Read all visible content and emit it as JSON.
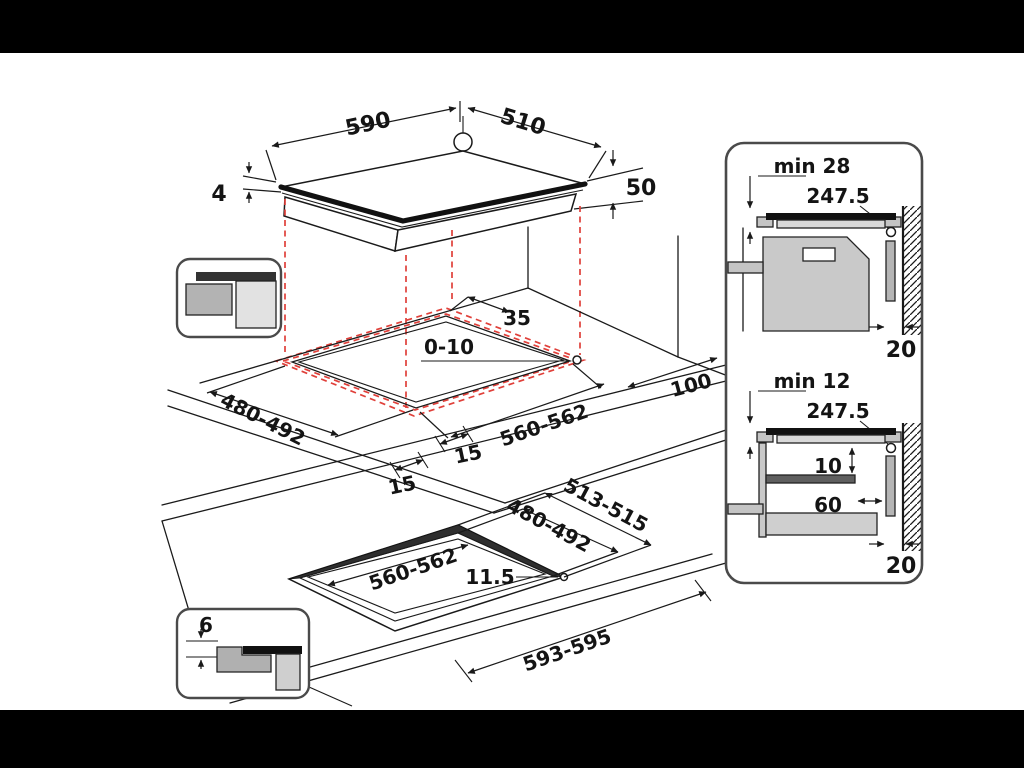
{
  "colors": {
    "background": "#000000",
    "canvas": "#ffffff",
    "line": "#1a1a1a",
    "projection_red": "#e0403a",
    "panel_border": "#4a4a4a"
  },
  "top_view": {
    "width": "590",
    "depth": "510",
    "hole_offset": "10",
    "glass_thickness": "4",
    "body_height": "50"
  },
  "cutout_view": {
    "rear_clearance": "35",
    "side_clearance": "0-10",
    "depth": "480-492",
    "width": "560-562",
    "front_min_left": "15",
    "front_min_right": "15",
    "rear_wall_distance": "100"
  },
  "flush_view": {
    "outer_depth": "513-515",
    "inner_depth": "480-492",
    "inner_width": "560-562",
    "corner_radius": "11.5",
    "outer_width": "593-595",
    "rebate_depth": "6"
  },
  "section_top": {
    "clearance": "min 28",
    "junction_box": "247.5",
    "rear_gap": "20"
  },
  "section_bottom": {
    "clearance": "min 12",
    "junction_box": "247.5",
    "shelf_gap": "10",
    "shelf_setback": "60",
    "rear_gap": "20"
  }
}
